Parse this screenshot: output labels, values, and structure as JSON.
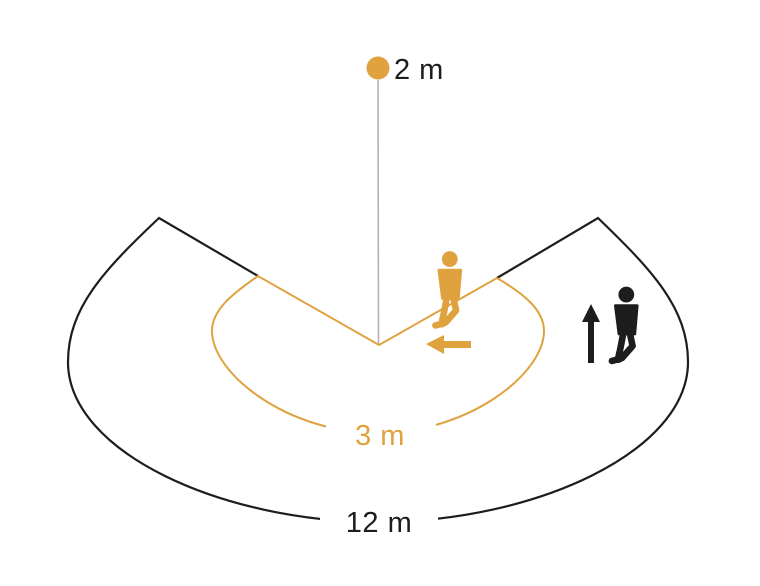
{
  "diagram": {
    "kind": "motion-sensor-detection-range",
    "mounting_height": {
      "label": "2 m"
    },
    "inner_range": {
      "label": "3 m"
    },
    "outer_range": {
      "label": "12 m"
    },
    "colors": {
      "orange": "#DFA23E",
      "black": "#1D1D1B",
      "gray_line": "#B3B3B3",
      "background": "#FFFFFF"
    },
    "icons": {
      "sensor": "sensor-dot",
      "inner_zone_walker": "walking-person-icon",
      "inner_zone_direction": "arrow-left-icon",
      "outer_zone_walker": "walking-person-icon",
      "outer_zone_direction": "arrow-up-icon"
    }
  }
}
